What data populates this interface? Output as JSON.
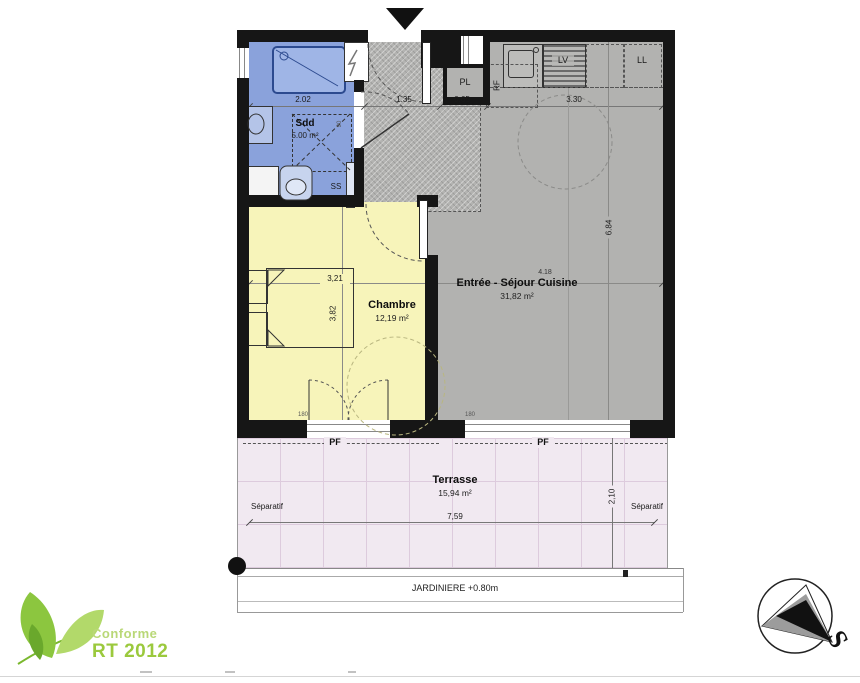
{
  "rooms": {
    "bathroom": {
      "name": "Sdd",
      "area": "5.00 m²",
      "dim_w": "2.02"
    },
    "entry": {
      "dim_w": "1.35"
    },
    "closet": {
      "label": "PL",
      "dim_w": "0.65"
    },
    "kitchen": {
      "dim_w": "3.30",
      "dishwasher": "LV",
      "washer": "LL",
      "fridge": "RF"
    },
    "living": {
      "name": "Entrée - Séjour Cuisine",
      "area": "31,82 m²",
      "dim_w": "4.18",
      "dim_h": "6.84"
    },
    "bedroom": {
      "name": "Chambre",
      "area": "12,19 m²",
      "dim_w": "3,21",
      "dim_h": "3,82"
    },
    "terrace": {
      "name": "Terrasse",
      "area": "15,94 m²",
      "dim_w": "7,59",
      "dim_h": "2,10",
      "separatif": "Séparatif",
      "jardiniere": "JARDINIERE  +0.80m"
    }
  },
  "annotations": {
    "pf": "PF",
    "ss": "SS",
    "window_width": "180",
    "shower_width": "90"
  },
  "logo": {
    "line1": "Conforme",
    "line2": "RT 2012"
  },
  "compass": {
    "letter": "S"
  },
  "colors": {
    "bathroom": "#8aa2db",
    "bedroom": "#f7f4ba",
    "living": "#b2b2b0",
    "terrace": "#f1e9f1",
    "wall": "#161616",
    "rt_green": "#9bc93d"
  }
}
